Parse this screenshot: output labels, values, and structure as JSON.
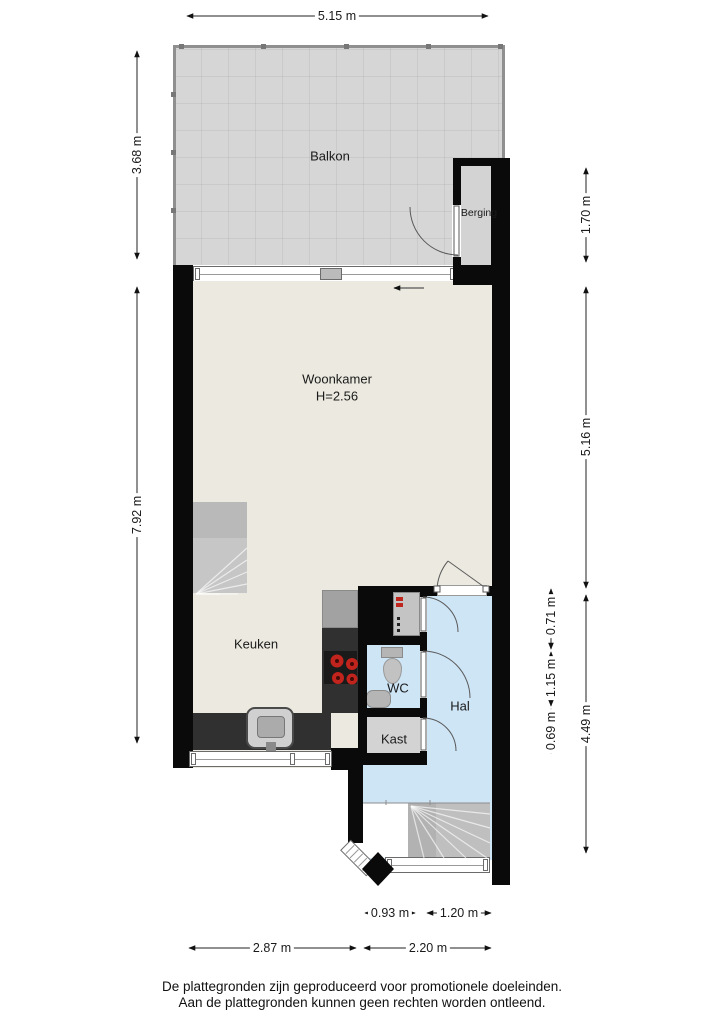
{
  "rooms": {
    "balkon": "Balkon",
    "berging": "Berging",
    "woonkamer": "Woonkamer",
    "woonkamer_height": "H=2.56",
    "keuken": "Keuken",
    "wc": "WC",
    "hal": "Hal",
    "kast": "Kast"
  },
  "dimensions": {
    "top_width": "5.15 m",
    "balkon_height": "3.68 m",
    "woning_height": "7.92 m",
    "berging_height": "1.70 m",
    "woonkamer_height": "5.16 m",
    "meterkast_height": "0.71 m",
    "wc_height": "1.15 m",
    "kast_height": "0.69 m",
    "hal_height": "4.49 m",
    "trap_width": "0.93 m",
    "window_width": "1.20 m",
    "keuken_width": "2.87 m",
    "hal_width": "2.20 m"
  },
  "footer": {
    "line1": "De plattegronden zijn geproduceerd voor promotionele doeleinden.",
    "line2": "Aan de plattegronden kunnen geen rechten worden ontleend."
  },
  "colors": {
    "wall": "#0a0a0a",
    "floor": "#eceae0",
    "wet_floor": "#cee5f6",
    "balkon_floor": "#d6d6d6",
    "storage_floor": "#d3d3d3",
    "counter": "#303030",
    "stairs": "#bfbfbf",
    "burner_red": "#c0241c"
  }
}
